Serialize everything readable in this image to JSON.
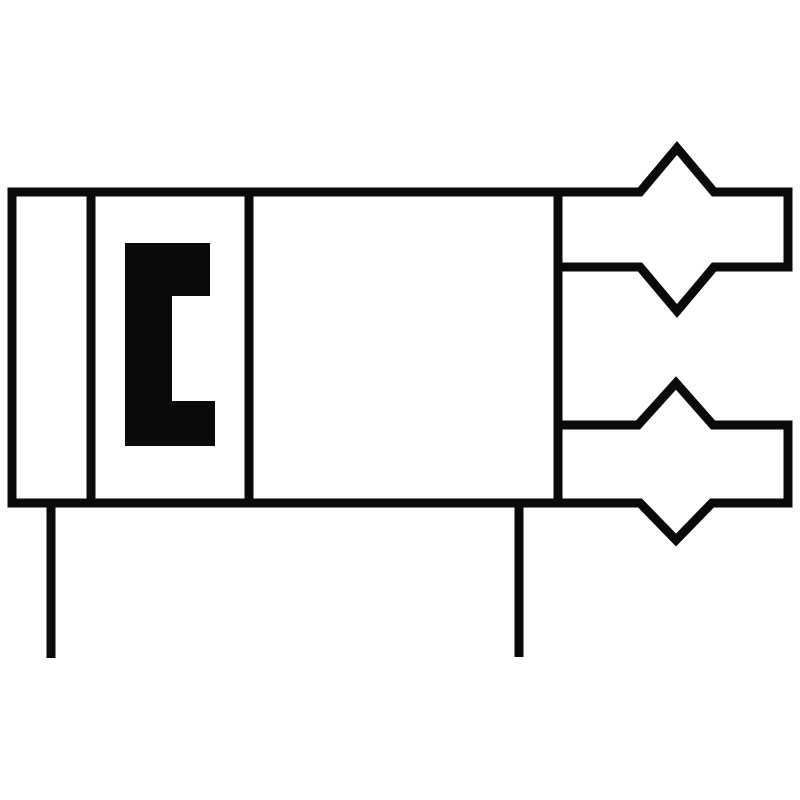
{
  "canvas": {
    "width": 800,
    "height": 800,
    "background_color": "#ffffff"
  },
  "style": {
    "stroke_color": "#0a0a0a",
    "fill_color": "#0a0a0a",
    "stroke_width": 9
  },
  "shapes": {
    "body_rect": {
      "description": "outer valve body rectangle",
      "path": "M 12 192 L 558 192 L 558 503 L 12 503 Z"
    },
    "divider_left": {
      "description": "divider between narrow left compartment and bracket compartment",
      "path": "M 91 192 L 91 503"
    },
    "divider_right": {
      "description": "divider between bracket compartment and main empty compartment",
      "path": "M 249 192 L 249 503"
    },
    "bracket_glyph": {
      "description": "solid black [ shaped glyph inside second compartment",
      "path": "M 125 243 L 210 243 L 210 296 L 172 296 L 172 401 L 215 401 L 215 446 L 125 446 Z"
    },
    "upper_coupling": {
      "description": "upper port coupling symbol: band with chevron peak above and V notch below, attached to body right border",
      "path": "M 558 192 L 640 192 L 677 148 L 714 192 L 788 192 L 788 267 L 714 267 L 677 311 L 640 267 L 558 267"
    },
    "lower_coupling": {
      "description": "lower port coupling symbol: band with chevron peak above and V notch below, attached to body right border",
      "path": "M 558 425 L 638 425 L 676 383 L 713 425 L 788 425 L 788 503 L 712 503 L 676 540 L 640 503 L 558 503"
    },
    "left_stem": {
      "description": "left vertical connection line below body",
      "path": "M 51 503 L 51 658"
    },
    "right_stem": {
      "description": "right vertical connection line below body",
      "path": "M 519 503 L 519 657"
    }
  }
}
